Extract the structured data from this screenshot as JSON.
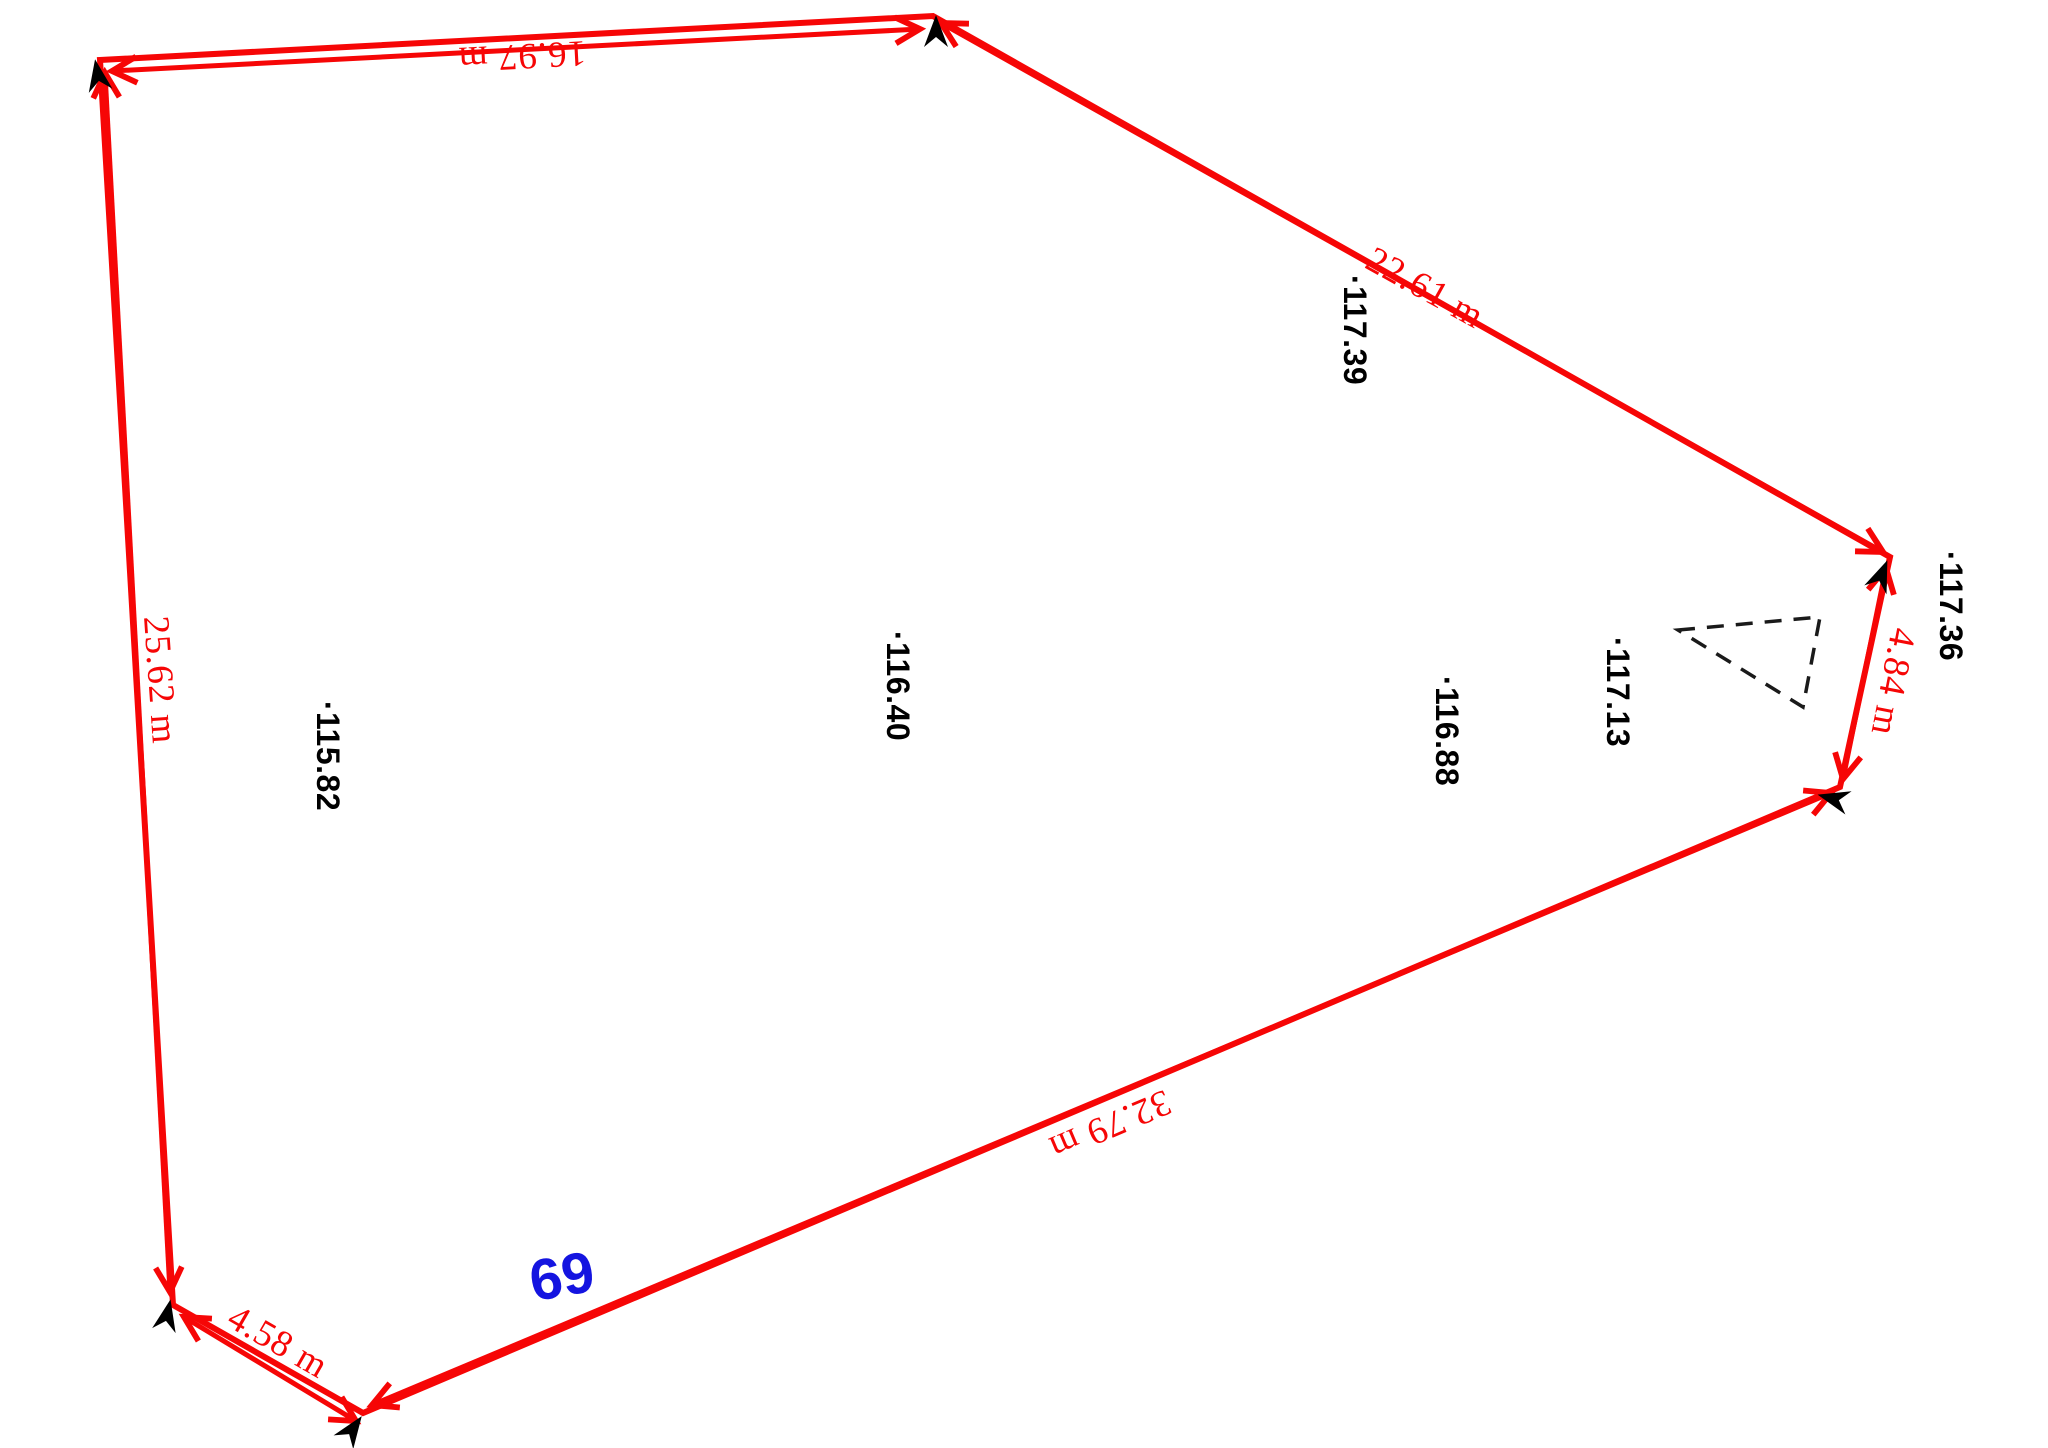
{
  "sketch": {
    "parcel_number": "69",
    "colors": {
      "boundary_red": "#f60606",
      "parcel_number_blue": "#1414e0",
      "elevation_black": "#000000",
      "marker_black": "#000000",
      "triangle_black": "#1a1a1a",
      "background": "#ffffff"
    },
    "dimensions": {
      "top": "16.97 m",
      "upper_right": "22.61 m",
      "right": "4.84 m",
      "lower": "32.79 m",
      "bottom_left": "4.58 m",
      "left": "25.62 m"
    },
    "elevations": {
      "p1": "·117.39",
      "p2": "·117.36",
      "p3": "·117.13",
      "p4": "·116.88",
      "p5": "·116.40",
      "p6": "·115.82"
    }
  }
}
